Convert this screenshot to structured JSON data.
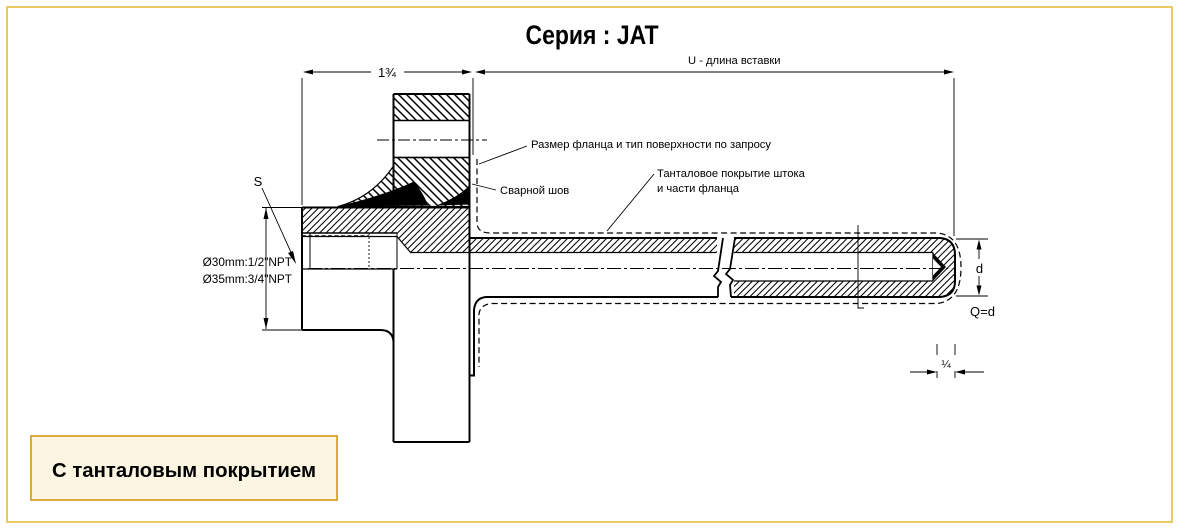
{
  "page": {
    "background": "#ffffff",
    "border_color": "#e8cb66"
  },
  "title": "Серия : JAT",
  "drawing": {
    "dim_top_left": "1¾",
    "dim_top_right": "U - длина вставки",
    "dim_s": "S",
    "npt_line1": "Ø30mm:1/2\"NPT",
    "npt_line2": "Ø35mm:3/4\"NPT",
    "note_flange": "Размер фланца и тип поверхности по запросу",
    "note_weld": "Сварной шов",
    "note_coating_line1": "Танталовое покрытие штока",
    "note_coating_line2": "и части фланца",
    "dim_d": "d",
    "dim_q": "Q=d",
    "dim_quarter": "¼",
    "line_color": "#000000"
  },
  "footer": {
    "label": "С танталовым покрытием",
    "background": "#fbf5e1",
    "border_color": "#dcaa3d"
  }
}
